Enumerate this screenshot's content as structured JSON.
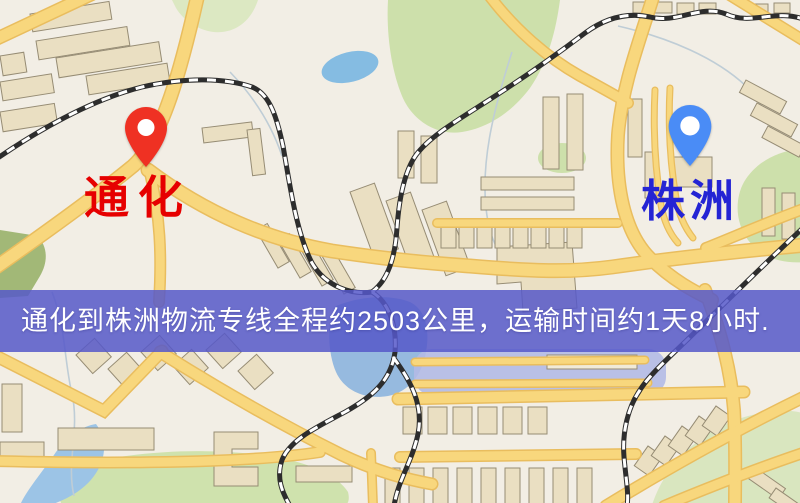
{
  "map": {
    "origin_marker": {
      "label": "通化",
      "pin_color": "#ef3123",
      "label_color": "#e60000"
    },
    "destination_marker": {
      "label": "株洲",
      "pin_color": "#4a8cf6",
      "label_color": "#2424d4"
    },
    "palette": {
      "background": "#f2eee5",
      "road_fill": "#f8d77d",
      "road_casing": "#e9bd5e",
      "railway": "#2d2d2d",
      "water": "#9fc3e5",
      "park": "#cde0ab",
      "building": "#eadfc2"
    }
  },
  "banner": {
    "text": "通化到株洲物流专线全程约2503公里，运输时间约1天8小时.",
    "origin": "通化",
    "destination": "株洲",
    "distance_km": "2503",
    "duration": "1天8小时",
    "background_color": "#5658c9",
    "text_color": "#ffffff"
  }
}
